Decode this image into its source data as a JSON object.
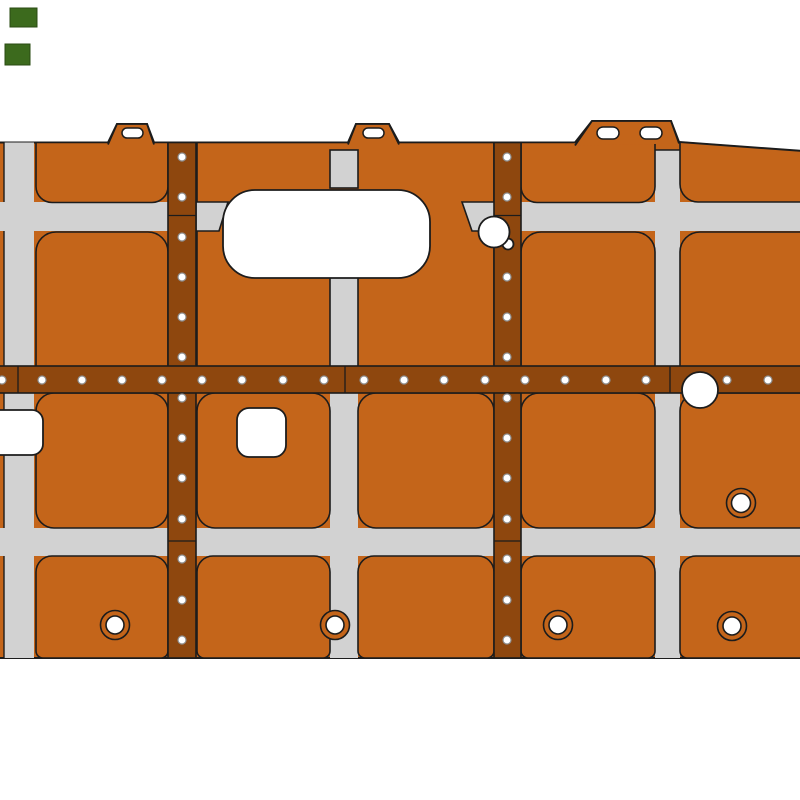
{
  "canvas": {
    "width": 800,
    "height": 800,
    "background": "#ffffff"
  },
  "colors": {
    "pocket": "#c4651a",
    "rib": "#8e470e",
    "web": "#d2d2d2",
    "white": "#ffffff",
    "outline": "#1c1c1c",
    "rivet_stroke": "#8f8f8f",
    "marker": "#3c6a1d",
    "marker_stroke": "#2a4b12"
  },
  "base_shapes": [
    {
      "name": "part-silhouette",
      "type": "path",
      "d": "M-3 142.5 L108 142.5 L117 124 L147 124 L154 142.5 L348 142.5 L356 124 L389 124 L399 142.5 L575 142.5 L592 121 L671 121 L679 142 L803 151 L803 658 L-3 658 Z",
      "fill": "pocket",
      "stroke": "outline",
      "sw": 2
    },
    {
      "name": "pocket-plate-obround-zone",
      "type": "rect",
      "x": 197,
      "y": 142.5,
      "w": 297,
      "h": 224,
      "fill": "pocket",
      "stroke": "outline",
      "sw": 1.6
    },
    {
      "name": "web-strip-left-column",
      "type": "rect",
      "x": 4,
      "y": 142.5,
      "w": 30,
      "h": 515.5,
      "fill": "web"
    },
    {
      "name": "web-strip-center-column-lower",
      "type": "rect",
      "x": 330,
      "y": 393,
      "w": 28,
      "h": 265,
      "fill": "web"
    },
    {
      "name": "web-strip-right-column",
      "type": "rect",
      "x": 655,
      "y": 150,
      "w": 25,
      "h": 508,
      "fill": "web"
    },
    {
      "name": "web-strip-upper-band-left",
      "type": "rect",
      "x": -3,
      "y": 202,
      "w": 199,
      "h": 29,
      "fill": "web"
    },
    {
      "name": "web-strip-upper-band-right",
      "type": "rect",
      "x": 496,
      "y": 202,
      "w": 307,
      "h": 29,
      "fill": "web"
    },
    {
      "name": "web-strip-lower-band",
      "type": "rect",
      "x": -3,
      "y": 528,
      "w": 806,
      "h": 28,
      "fill": "web"
    },
    {
      "name": "web-strip-center-column-top",
      "type": "rect",
      "x": 330,
      "y": 150,
      "w": 28,
      "h": 38,
      "fill": "web",
      "stroke": "outline",
      "sw": 1.6
    },
    {
      "name": "web-strip-center-column-mid",
      "type": "rect",
      "x": 330,
      "y": 272,
      "w": 28,
      "h": 96,
      "fill": "web",
      "stroke": "outline",
      "sw": 1.6
    },
    {
      "name": "web-band-end-cap-left",
      "type": "poly",
      "pts": [
        [
          196,
          202
        ],
        [
          228,
          202
        ],
        [
          219,
          231
        ],
        [
          196,
          231
        ]
      ],
      "fill": "web",
      "stroke": "outline",
      "sw": 1.6
    },
    {
      "name": "web-band-end-cap-right",
      "type": "poly",
      "pts": [
        [
          462,
          202
        ],
        [
          496,
          202
        ],
        [
          496,
          231
        ],
        [
          472,
          231
        ]
      ],
      "fill": "web",
      "stroke": "outline",
      "sw": 1.6
    },
    {
      "name": "pocket-a1",
      "type": "rrect",
      "x": 36,
      "y": 142.5,
      "w": 132,
      "h": 60,
      "r": [
        0,
        0,
        16,
        16
      ],
      "fill": "pocket",
      "stroke": "outline",
      "sw": 1.6
    },
    {
      "name": "pocket-d1",
      "type": "rrect",
      "x": 521,
      "y": 142.5,
      "w": 134,
      "h": 60,
      "r": [
        0,
        0,
        16,
        16
      ],
      "fill": "pocket",
      "stroke": "outline",
      "sw": 1.6
    },
    {
      "name": "pocket-e1",
      "type": "path",
      "d": "M680 142.2 L803 151.2 L803 202 L698 202 A18 18 0 0 1 680 184 Z",
      "fill": "pocket",
      "stroke": "outline",
      "sw": 1.6
    },
    {
      "name": "pocket-a2",
      "type": "rrect",
      "x": 36,
      "y": 232,
      "w": 132,
      "h": 135,
      "r": [
        20,
        20,
        0,
        0
      ],
      "fill": "pocket",
      "stroke": "outline",
      "sw": 1.6
    },
    {
      "name": "pocket-d2",
      "type": "rrect",
      "x": 521,
      "y": 232,
      "w": 134,
      "h": 135,
      "r": [
        20,
        20,
        0,
        0
      ],
      "fill": "pocket",
      "stroke": "outline",
      "sw": 1.6
    },
    {
      "name": "pocket-e2",
      "type": "rrect",
      "x": 680,
      "y": 232,
      "w": 123,
      "h": 135,
      "r": [
        20,
        0,
        0,
        0
      ],
      "fill": "pocket",
      "stroke": "outline",
      "sw": 1.6
    },
    {
      "name": "pocket-a3",
      "type": "rrect",
      "x": 36,
      "y": 393,
      "w": 132,
      "h": 135,
      "r": [
        18,
        18,
        18,
        18
      ],
      "fill": "pocket",
      "stroke": "outline",
      "sw": 1.6
    },
    {
      "name": "pocket-b3",
      "type": "rrect",
      "x": 197,
      "y": 393,
      "w": 133,
      "h": 135,
      "r": [
        18,
        18,
        18,
        18
      ],
      "fill": "pocket",
      "stroke": "outline",
      "sw": 1.6
    },
    {
      "name": "pocket-c3",
      "type": "rrect",
      "x": 358,
      "y": 393,
      "w": 136,
      "h": 135,
      "r": [
        18,
        18,
        18,
        18
      ],
      "fill": "pocket",
      "stroke": "outline",
      "sw": 1.6
    },
    {
      "name": "pocket-d3",
      "type": "rrect",
      "x": 521,
      "y": 393,
      "w": 134,
      "h": 135,
      "r": [
        18,
        18,
        18,
        18
      ],
      "fill": "pocket",
      "stroke": "outline",
      "sw": 1.6
    },
    {
      "name": "pocket-e3",
      "type": "rrect",
      "x": 680,
      "y": 393,
      "w": 123,
      "h": 135,
      "r": [
        18,
        0,
        0,
        18
      ],
      "fill": "pocket",
      "stroke": "outline",
      "sw": 1.6
    },
    {
      "name": "pocket-a4",
      "type": "rrect",
      "x": 36,
      "y": 556,
      "w": 132,
      "h": 102,
      "r": [
        16,
        16,
        7,
        7
      ],
      "fill": "pocket",
      "stroke": "outline",
      "sw": 1.6
    },
    {
      "name": "pocket-b4",
      "type": "rrect",
      "x": 197,
      "y": 556,
      "w": 133,
      "h": 102,
      "r": [
        16,
        16,
        7,
        7
      ],
      "fill": "pocket",
      "stroke": "outline",
      "sw": 1.6
    },
    {
      "name": "pocket-c4",
      "type": "rrect",
      "x": 358,
      "y": 556,
      "w": 136,
      "h": 102,
      "r": [
        16,
        16,
        7,
        7
      ],
      "fill": "pocket",
      "stroke": "outline",
      "sw": 1.6
    },
    {
      "name": "pocket-d4",
      "type": "rrect",
      "x": 521,
      "y": 556,
      "w": 134,
      "h": 102,
      "r": [
        16,
        16,
        7,
        7
      ],
      "fill": "pocket",
      "stroke": "outline",
      "sw": 1.6
    },
    {
      "name": "pocket-e4",
      "type": "rrect",
      "x": 680,
      "y": 556,
      "w": 123,
      "h": 102,
      "r": [
        16,
        0,
        0,
        7
      ],
      "fill": "pocket",
      "stroke": "outline",
      "sw": 1.6
    },
    {
      "name": "pocket-edge-line",
      "type": "line",
      "x1": 4,
      "y1": 142.5,
      "x2": 4,
      "y2": 202,
      "stroke": "outline",
      "sw": 1.4
    },
    {
      "name": "pocket-edge-line",
      "type": "line",
      "x1": 4,
      "y1": 231,
      "x2": 4,
      "y2": 366,
      "stroke": "outline",
      "sw": 1.4
    },
    {
      "name": "pocket-edge-line",
      "type": "line",
      "x1": 4,
      "y1": 393,
      "x2": 4,
      "y2": 528,
      "stroke": "outline",
      "sw": 1.4
    },
    {
      "name": "pocket-edge-line",
      "type": "line",
      "x1": 4,
      "y1": 556,
      "x2": 4,
      "y2": 658,
      "stroke": "outline",
      "sw": 1.4
    },
    {
      "name": "web-top-line-right-column",
      "type": "line",
      "x1": 655,
      "y1": 150,
      "x2": 680,
      "y2": 150,
      "stroke": "outline",
      "sw": 1.4
    },
    {
      "name": "edge-tab-1",
      "type": "path",
      "d": "M108 144.5 L117 124 L147 124 L154 144.5",
      "fill": "pocket",
      "stroke": "outline",
      "sw": 1.8
    },
    {
      "name": "edge-tab-2",
      "type": "path",
      "d": "M348 144.5 L356 124 L389 124 L399 144.5",
      "fill": "pocket",
      "stroke": "outline",
      "sw": 1.8
    },
    {
      "name": "edge-tab-3",
      "type": "path",
      "d": "M575 145.5 L592 121 L671 121 L679 143.5",
      "fill": "pocket",
      "stroke": "outline",
      "sw": 1.8
    },
    {
      "name": "rib-strap-vertical-1",
      "type": "rect",
      "x": 168,
      "y": 142.5,
      "w": 28,
      "h": 515.5,
      "fill": "rib",
      "stroke": "outline",
      "sw": 1.6
    },
    {
      "name": "rib-strap-vertical-2",
      "type": "rect",
      "x": 494,
      "y": 142.5,
      "w": 27,
      "h": 515.5,
      "fill": "rib",
      "stroke": "outline",
      "sw": 1.6
    },
    {
      "name": "rib-strap-horizontal",
      "type": "rect",
      "x": -3,
      "y": 366,
      "w": 806,
      "h": 27,
      "fill": "rib",
      "stroke": "outline",
      "sw": 1.6
    },
    {
      "name": "rib-seam",
      "type": "line",
      "x1": 168,
      "y1": 215.5,
      "x2": 196,
      "y2": 215.5,
      "stroke": "outline",
      "sw": 1.3
    },
    {
      "name": "rib-seam",
      "type": "line",
      "x1": 494,
      "y1": 215.5,
      "x2": 521,
      "y2": 215.5,
      "stroke": "outline",
      "sw": 1.3
    },
    {
      "name": "rib-seam",
      "type": "line",
      "x1": 168,
      "y1": 541,
      "x2": 196,
      "y2": 541,
      "stroke": "outline",
      "sw": 1.3
    },
    {
      "name": "rib-seam",
      "type": "line",
      "x1": 494,
      "y1": 541,
      "x2": 521,
      "y2": 541,
      "stroke": "outline",
      "sw": 1.3
    },
    {
      "name": "rib-seam",
      "type": "line",
      "x1": 18,
      "y1": 366,
      "x2": 18,
      "y2": 393,
      "stroke": "outline",
      "sw": 1.3
    },
    {
      "name": "rib-seam",
      "type": "line",
      "x1": 345,
      "y1": 366,
      "x2": 345,
      "y2": 393,
      "stroke": "outline",
      "sw": 1.3
    },
    {
      "name": "rib-seam",
      "type": "line",
      "x1": 670,
      "y1": 366,
      "x2": 670,
      "y2": 393,
      "stroke": "outline",
      "sw": 1.3
    }
  ],
  "rivets": {
    "radius": 4,
    "stroke_width": 1.2,
    "vertical_rows": [
      {
        "x": 182,
        "ys": [
          157,
          197,
          237,
          277,
          317,
          357,
          398,
          438,
          478,
          519,
          559,
          600,
          640
        ]
      },
      {
        "x": 507,
        "ys": [
          157,
          197,
          277,
          317,
          357,
          398,
          438,
          478,
          519,
          559,
          600,
          640
        ]
      }
    ],
    "horizontal_row": {
      "y": 380,
      "xs": [
        2,
        42,
        82,
        122,
        162,
        202,
        242,
        283,
        324,
        364,
        404,
        444,
        485,
        525,
        565,
        606,
        646,
        727,
        768
      ]
    }
  },
  "top_shapes": [
    {
      "name": "circular-cutout-notch",
      "type": "circle",
      "cx": 508,
      "cy": 244,
      "r": 5.5,
      "fill": "white",
      "stroke": "outline",
      "sw": 1.8
    },
    {
      "name": "circular-cutout-small",
      "type": "circle",
      "cx": 494,
      "cy": 232,
      "r": 15.5,
      "fill": "white",
      "stroke": "outline",
      "sw": 1.8
    },
    {
      "name": "obround-cutout",
      "type": "rrect",
      "x": 223,
      "y": 190,
      "w": 207,
      "h": 88,
      "r": [
        32,
        32,
        32,
        32
      ],
      "fill": "white",
      "stroke": "outline",
      "sw": 1.8
    },
    {
      "name": "circular-cutout-large",
      "type": "circle",
      "cx": 700,
      "cy": 390,
      "r": 18,
      "fill": "white",
      "stroke": "outline",
      "sw": 1.8
    },
    {
      "name": "square-cutout-left",
      "type": "rrect",
      "x": -12,
      "y": 410,
      "w": 55,
      "h": 45,
      "r": [
        11,
        11,
        11,
        11
      ],
      "fill": "white",
      "stroke": "outline",
      "sw": 1.8
    },
    {
      "name": "square-cutout-center",
      "type": "rrect",
      "x": 237,
      "y": 408,
      "w": 49,
      "h": 49,
      "r": [
        12,
        12,
        12,
        12
      ],
      "fill": "white",
      "stroke": "outline",
      "sw": 1.8
    },
    {
      "name": "tab-slot",
      "type": "rrect",
      "x": 122,
      "y": 128,
      "w": 21,
      "h": 10,
      "r": [
        5,
        5,
        5,
        5
      ],
      "fill": "white",
      "stroke": "outline",
      "sw": 1.5
    },
    {
      "name": "tab-slot",
      "type": "rrect",
      "x": 363,
      "y": 128,
      "w": 21,
      "h": 10,
      "r": [
        5,
        5,
        5,
        5
      ],
      "fill": "white",
      "stroke": "outline",
      "sw": 1.5
    },
    {
      "name": "tab-slot",
      "type": "rrect",
      "x": 597,
      "y": 127,
      "w": 22,
      "h": 12,
      "r": [
        6,
        6,
        6,
        6
      ],
      "fill": "white",
      "stroke": "outline",
      "sw": 1.5
    },
    {
      "name": "tab-slot",
      "type": "rrect",
      "x": 640,
      "y": 127,
      "w": 22,
      "h": 12,
      "r": [
        6,
        6,
        6,
        6
      ],
      "fill": "white",
      "stroke": "outline",
      "sw": 1.5
    },
    {
      "name": "grommet-ring",
      "type": "circle",
      "cx": 115,
      "cy": 625,
      "r": 14.5,
      "fill": "pocket",
      "stroke": "outline",
      "sw": 1.6
    },
    {
      "name": "grommet-hole",
      "type": "circle",
      "cx": 115,
      "cy": 625,
      "r": 9,
      "fill": "white",
      "stroke": "outline",
      "sw": 1.6
    },
    {
      "name": "grommet-ring",
      "type": "circle",
      "cx": 335,
      "cy": 625,
      "r": 14.5,
      "fill": "pocket",
      "stroke": "outline",
      "sw": 1.6
    },
    {
      "name": "grommet-hole",
      "type": "circle",
      "cx": 335,
      "cy": 625,
      "r": 9,
      "fill": "white",
      "stroke": "outline",
      "sw": 1.6
    },
    {
      "name": "grommet-ring",
      "type": "circle",
      "cx": 558,
      "cy": 625,
      "r": 14.5,
      "fill": "pocket",
      "stroke": "outline",
      "sw": 1.6
    },
    {
      "name": "grommet-hole",
      "type": "circle",
      "cx": 558,
      "cy": 625,
      "r": 9,
      "fill": "white",
      "stroke": "outline",
      "sw": 1.6
    },
    {
      "name": "grommet-ring",
      "type": "circle",
      "cx": 732,
      "cy": 626,
      "r": 14.5,
      "fill": "pocket",
      "stroke": "outline",
      "sw": 1.6
    },
    {
      "name": "grommet-hole",
      "type": "circle",
      "cx": 732,
      "cy": 626,
      "r": 9,
      "fill": "white",
      "stroke": "outline",
      "sw": 1.6
    },
    {
      "name": "grommet-ring",
      "type": "circle",
      "cx": 741,
      "cy": 503,
      "r": 14.5,
      "fill": "pocket",
      "stroke": "outline",
      "sw": 1.6
    },
    {
      "name": "grommet-hole",
      "type": "circle",
      "cx": 741,
      "cy": 503,
      "r": 9.5,
      "fill": "white",
      "stroke": "outline",
      "sw": 1.6
    },
    {
      "name": "green-marker",
      "type": "rect",
      "x": 10,
      "y": 8,
      "w": 27,
      "h": 19,
      "fill": "marker",
      "stroke": "marker_stroke",
      "sw": 1
    },
    {
      "name": "green-marker",
      "type": "rect",
      "x": 5,
      "y": 44,
      "w": 25,
      "h": 21,
      "fill": "marker",
      "stroke": "marker_stroke",
      "sw": 1
    }
  ]
}
